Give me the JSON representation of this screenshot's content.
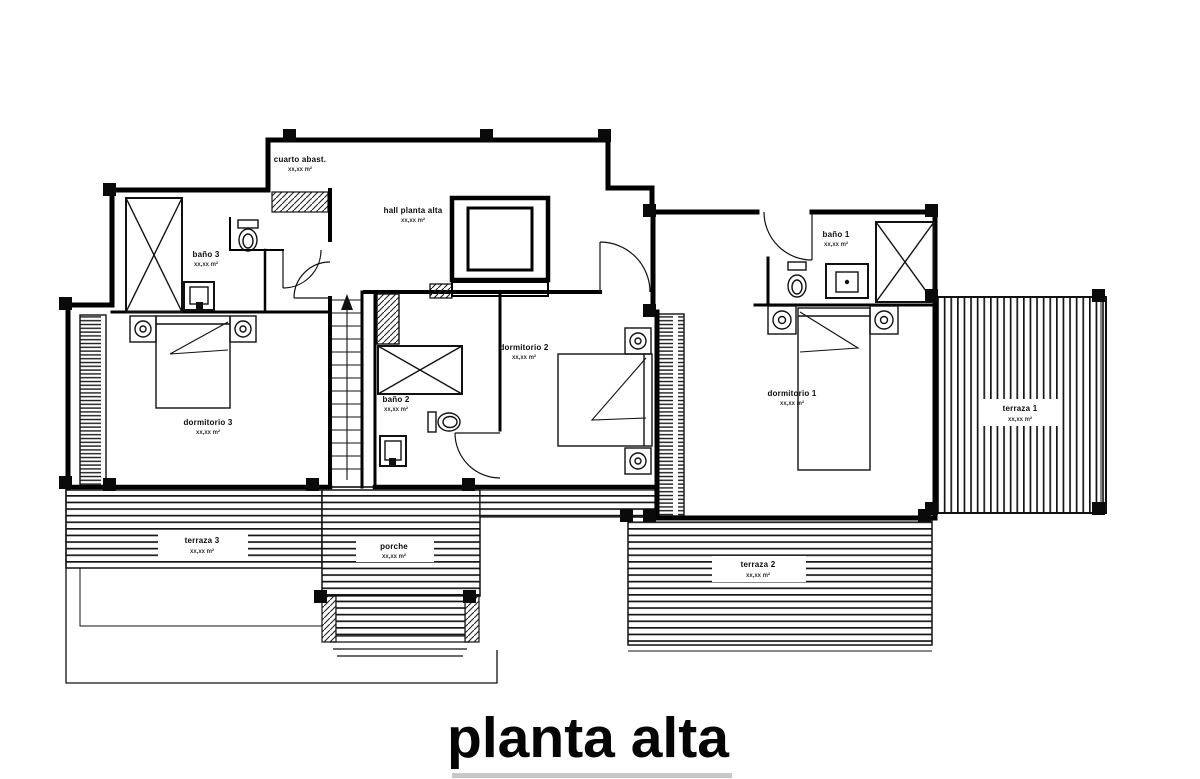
{
  "page": {
    "background": "#ffffff",
    "line_color": "#000000"
  },
  "title": "planta alta",
  "rooms": {
    "cuarto_abast": {
      "name": "cuarto abast.",
      "area": "xx,xx m²"
    },
    "hall": {
      "name": "hall planta alta",
      "area": "xx,xx m²"
    },
    "bano3": {
      "name": "baño 3",
      "area": "xx,xx m²"
    },
    "dormitorio3": {
      "name": "dormitorio 3",
      "area": "xx,xx m²"
    },
    "bano2": {
      "name": "baño 2",
      "area": "xx,xx m²"
    },
    "dormitorio2": {
      "name": "dormitorio 2",
      "area": "xx,xx m²"
    },
    "bano1": {
      "name": "baño 1",
      "area": "xx,xx m²"
    },
    "dormitorio1": {
      "name": "dormitorio 1",
      "area": "xx,xx m²"
    },
    "terraza1": {
      "name": "terraza 1",
      "area": "xx,xx m²"
    },
    "terraza2": {
      "name": "terraza 2",
      "area": "xx,xx m²"
    },
    "terraza3": {
      "name": "terraza 3",
      "area": "xx,xx m²"
    },
    "porche": {
      "name": "porche",
      "area": "xx,xx m²"
    }
  }
}
